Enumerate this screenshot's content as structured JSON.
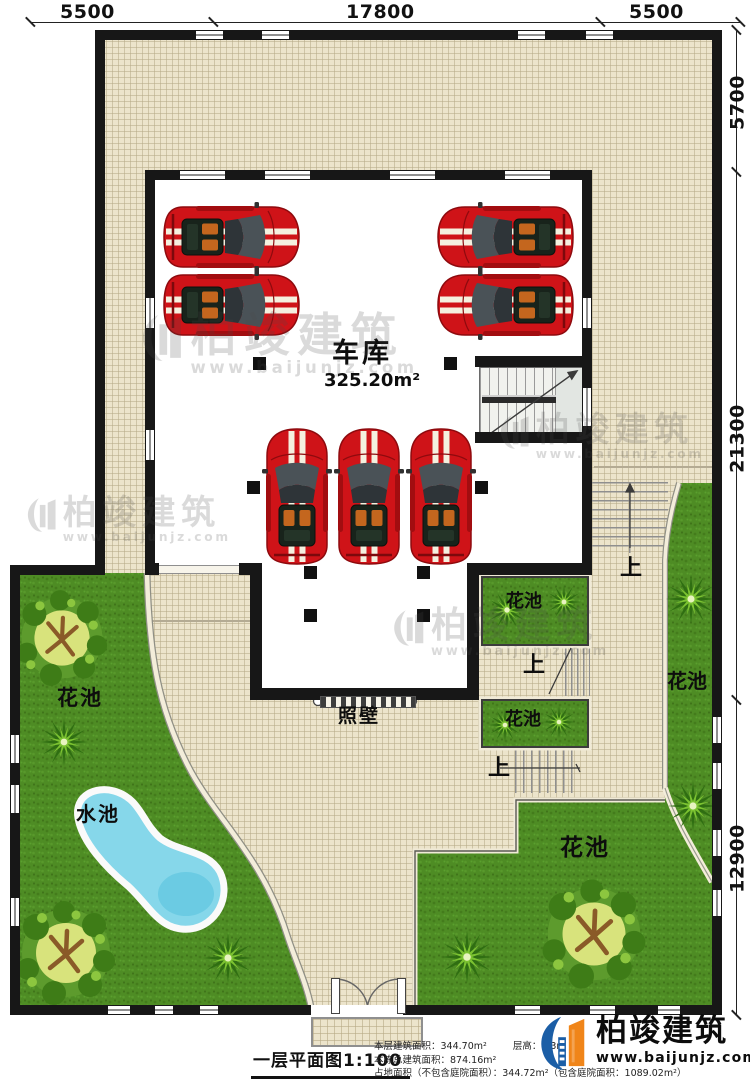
{
  "plan": {
    "garage_label": "车库",
    "garage_area": "325.20m²",
    "screen_wall": "照壁",
    "flower_bed": "花池",
    "water_pool": "水池",
    "up": "上"
  },
  "dimensions": {
    "top": [
      "5500",
      "17800",
      "5500"
    ],
    "right": [
      "5700",
      "21300",
      "12900"
    ]
  },
  "title_block": {
    "title": "一层平面图1:100",
    "floor_area": "本层建筑面积：344.70m²",
    "floor_height": "层高：3.3m",
    "total_area": "本栋总建筑面积：874.16m²",
    "land_area": "占地面积（不包含庭院面积）：344.72m²（包含庭院面积：1089.02m²）"
  },
  "brand": {
    "name": "柏竣建筑",
    "website": "www.baijunjz.com"
  },
  "watermark": {
    "name": "柏竣建筑",
    "website": "www.baijunjz.com"
  },
  "colors": {
    "wall": "#171717",
    "paving": "#ece4cb",
    "grass": "#4e8c24",
    "pool": "#86d7ea",
    "car_red": "#cf1318",
    "logo_blue": "#1b5ea6",
    "logo_orange": "#f08519"
  }
}
